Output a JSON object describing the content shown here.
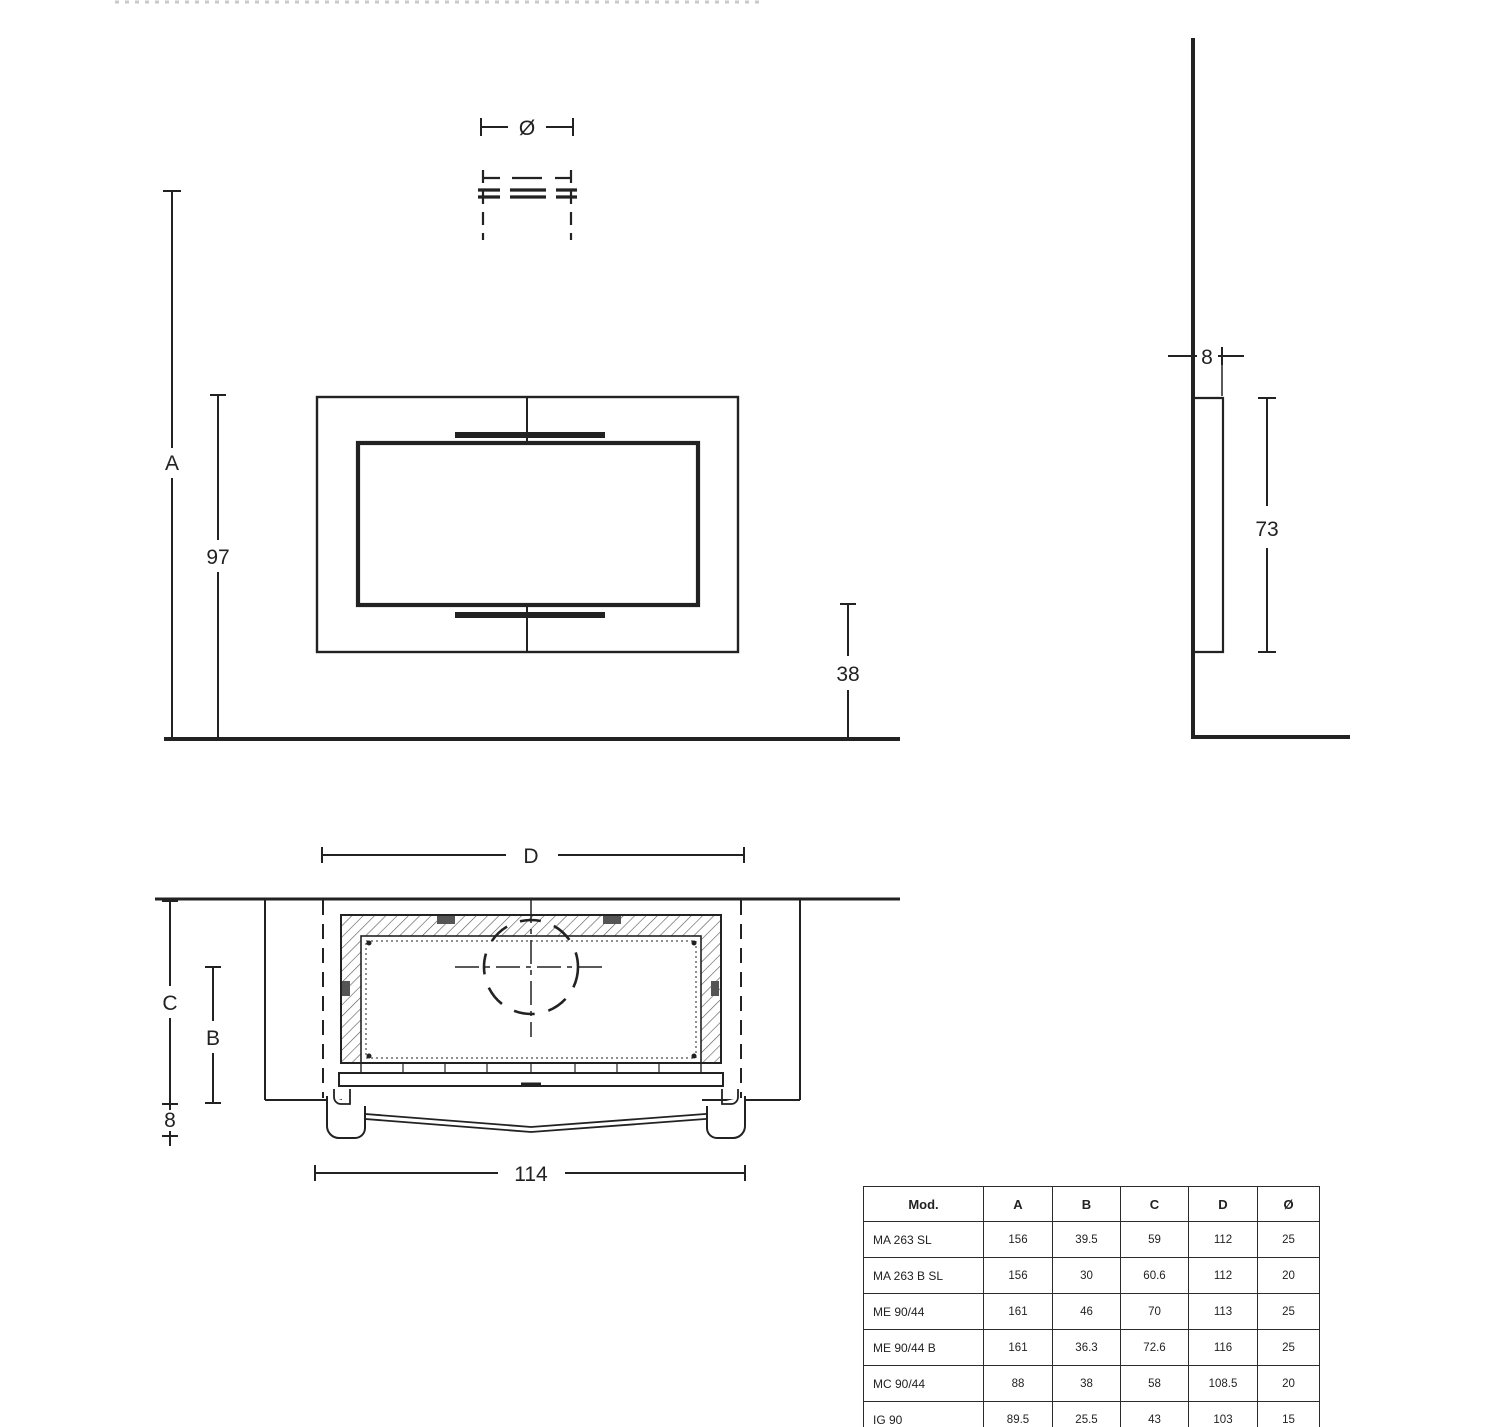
{
  "drawing": {
    "front_view": {
      "flue_diameter_label": "Ø",
      "total_height_label": "A",
      "frame_height": "97",
      "hearth_height": "38"
    },
    "side_view": {
      "wall_ledge_depth": "8",
      "panel_height": "73"
    },
    "plan_view": {
      "niche_width_label": "D",
      "niche_depth_label": "C",
      "body_depth_label": "B",
      "ledge_depth": "8",
      "overall_width": "114"
    },
    "colors": {
      "line": "#222222",
      "hatch": "#555555",
      "background": "#ffffff"
    }
  },
  "table": {
    "headers": [
      "Mod.",
      "A",
      "B",
      "C",
      "D",
      "Ø"
    ],
    "rows": [
      {
        "model": "MA 263 SL",
        "a": "156",
        "b": "39.5",
        "c": "59",
        "d": "112",
        "dia": "25"
      },
      {
        "model": "MA 263 B SL",
        "a": "156",
        "b": "30",
        "c": "60.6",
        "d": "112",
        "dia": "20"
      },
      {
        "model": "ME 90/44",
        "a": "161",
        "b": "46",
        "c": "70",
        "d": "113",
        "dia": "25"
      },
      {
        "model": "ME 90/44 B",
        "a": "161",
        "b": "36.3",
        "c": "72.6",
        "d": "116",
        "dia": "25"
      },
      {
        "model": "MC 90/44",
        "a": "88",
        "b": "38",
        "c": "58",
        "d": "108.5",
        "dia": "20"
      },
      {
        "model": "IG 90",
        "a": "89.5",
        "b": "25.5",
        "c": "43",
        "d": "103",
        "dia": "15"
      }
    ]
  }
}
